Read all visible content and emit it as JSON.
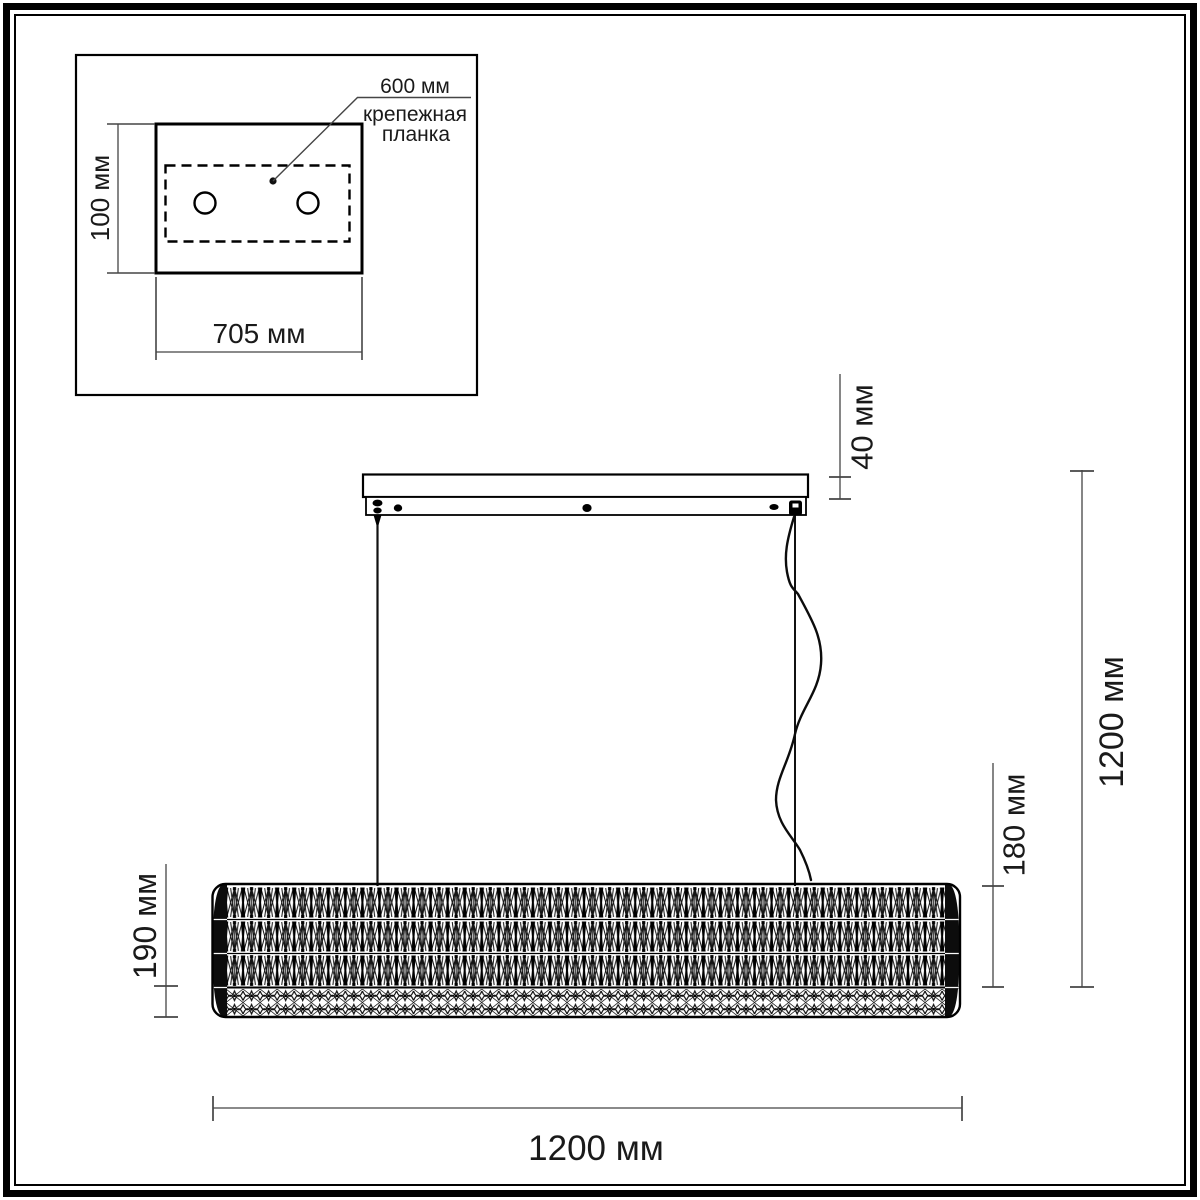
{
  "drawing": {
    "kind": "pendant-light dimension drawing",
    "units_suffix": "мм",
    "colors": {
      "line": "#000000",
      "dim_line": "#454545",
      "text": "#1a1a1a",
      "background": "#ffffff"
    },
    "inset": {
      "plate_height": "100 мм",
      "plate_width": "705 мм",
      "callout_value": "600 мм",
      "callout_label_line1": "крепежная",
      "callout_label_line2": "планка"
    },
    "main": {
      "canopy_height": "40 мм",
      "suspension_overall_height": "1200 мм",
      "shade_height": "180 мм",
      "shade_total_height": "190 мм",
      "fixture_width": "1200 мм"
    }
  }
}
